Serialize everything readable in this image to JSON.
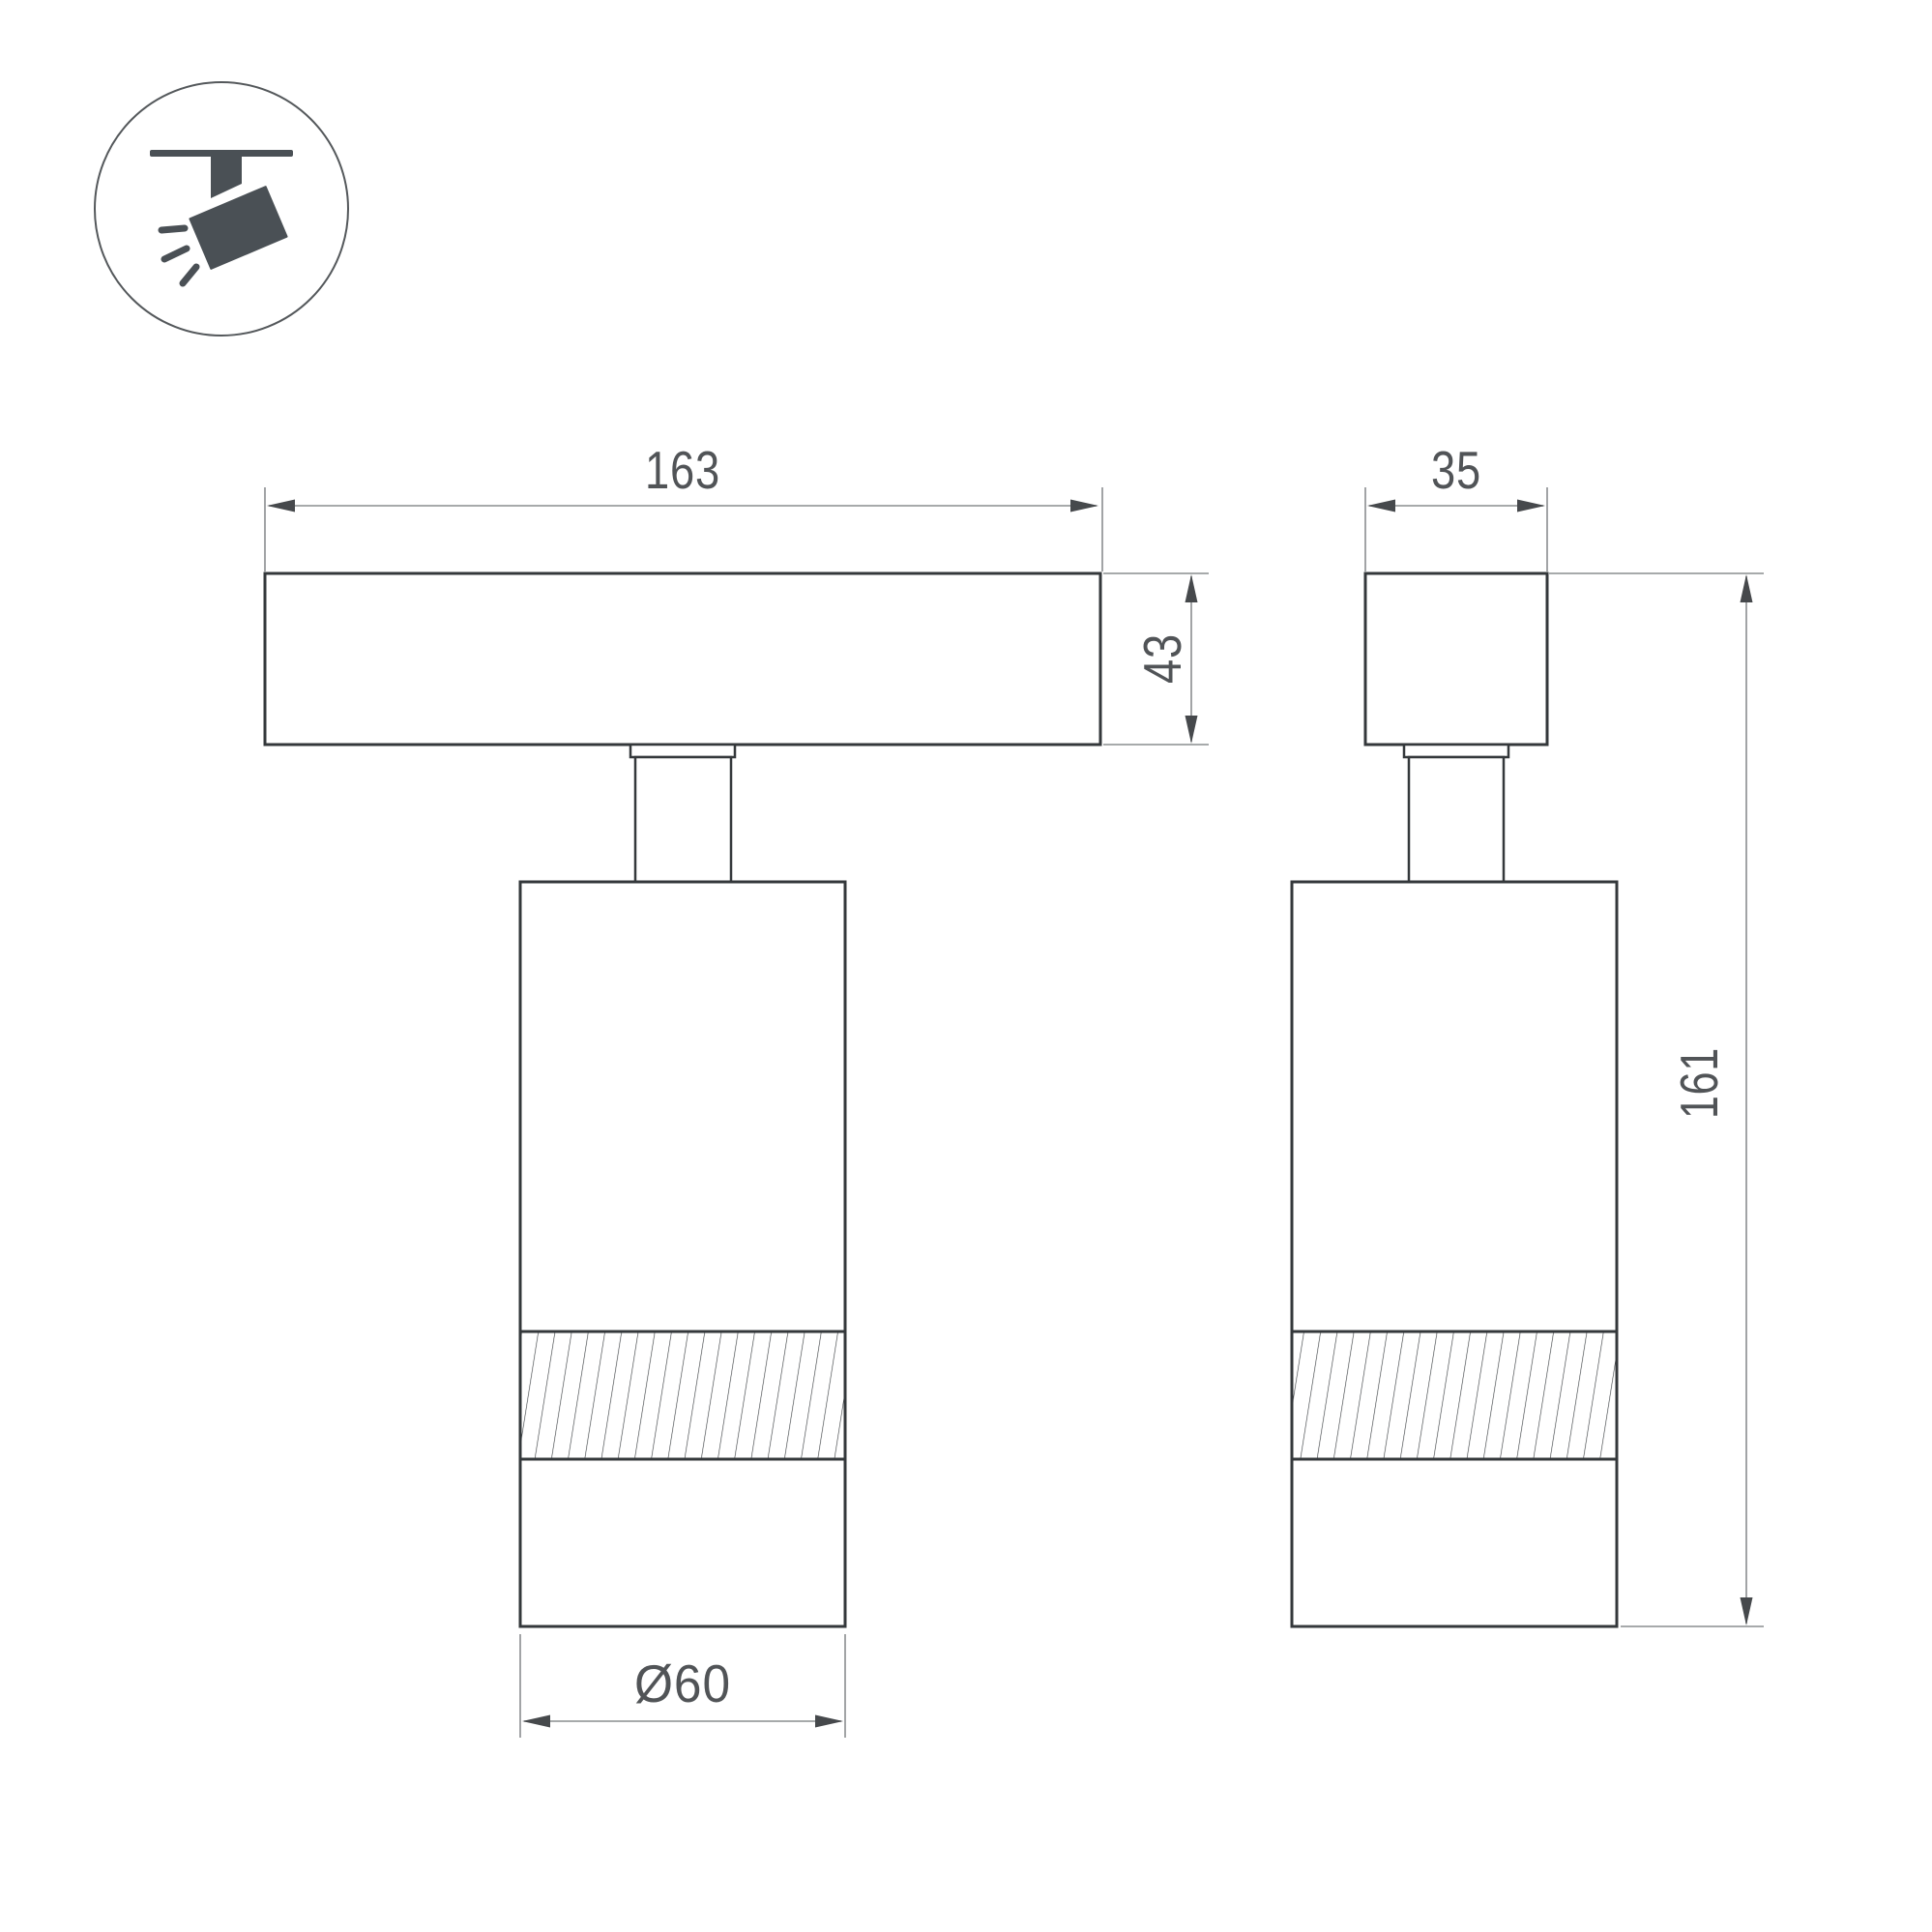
{
  "drawing": {
    "kind": "technical-dimension-drawing",
    "background": "#ffffff",
    "colors": {
      "outline": "#34383b",
      "dimension_line": "#8a8d8f",
      "arrowhead": "#46494c",
      "label_text": "#515457",
      "hatch": "#3f4346",
      "icon": "#4a5055"
    }
  },
  "icon": {
    "name": "track-spotlight-icon"
  },
  "views": {
    "front": {
      "width_label": "163",
      "height_label": "43",
      "diameter_label": "Ø60"
    },
    "side": {
      "width_label": "35",
      "height_label": "161"
    }
  }
}
